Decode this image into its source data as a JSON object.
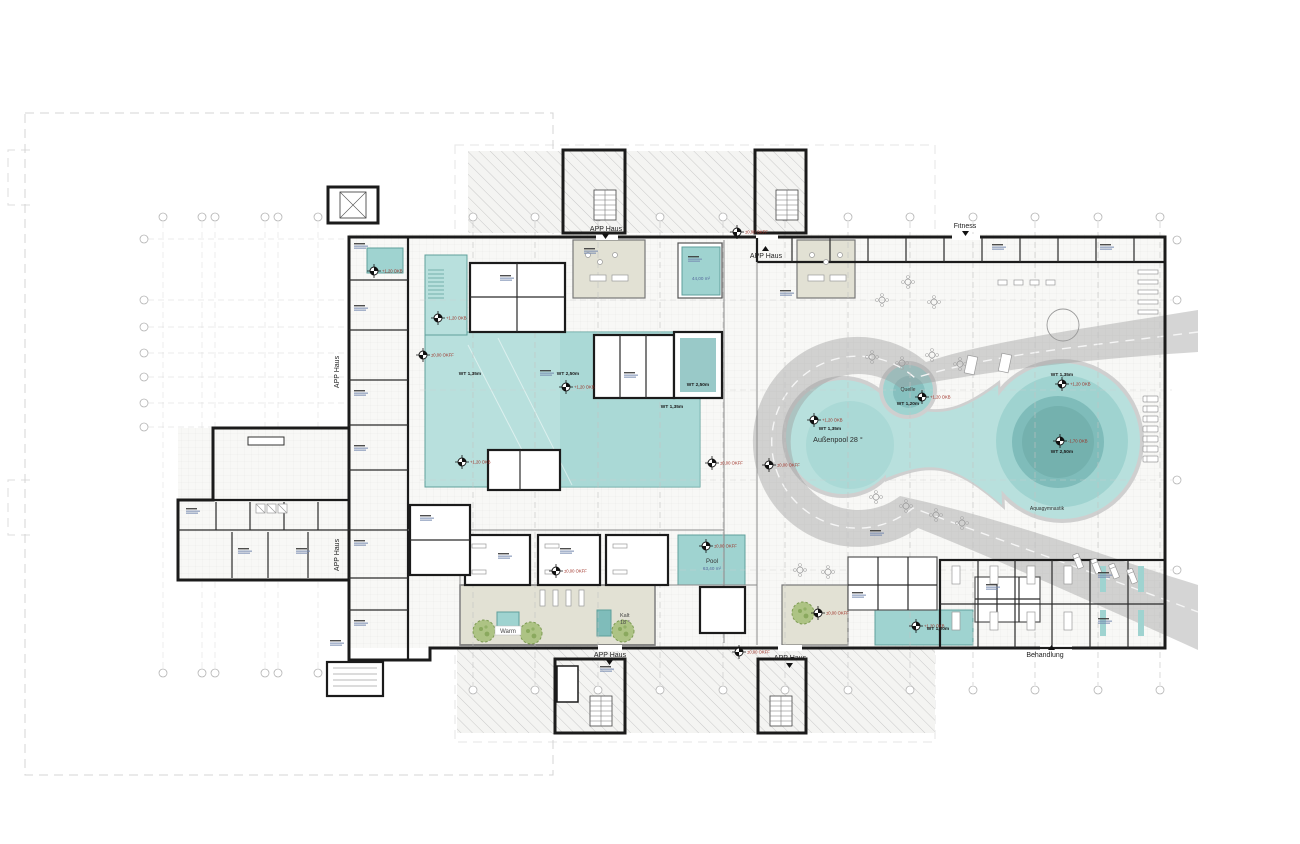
{
  "plan": {
    "areas": {
      "fitness": "Fitness",
      "behandlung": "Behandlung",
      "app_haus": "APP Haus",
      "aussenpool": "Außenpool 28 °",
      "quelle": "Quelle",
      "aquagym": "Aquagymnastik",
      "warm": "Warm",
      "kalt1": "Kalt",
      "kalt2": "18 °",
      "pool": "Pool"
    },
    "measurements": {
      "pool_area": "63,40 m²",
      "small_pool_area": "44,00 m²",
      "wt135": "WT 1,35m",
      "wt250": "WT 2,50m",
      "wt120": "WT 1,20m"
    },
    "levels": {
      "okff0": "±0,00 OKFF",
      "okb120": "+1,20 OKB",
      "okb170n": "-1,70 OKB"
    },
    "colors": {
      "pool_light": "#b8e0dd",
      "pool_mid": "#9fd3d0",
      "pool_deep": "#7fbcba",
      "pool_deepest": "#74b1ae",
      "band_gray": "#9a9a9a",
      "beige": "#e2e1d4",
      "tree_green": "#a3bd76",
      "wall_black": "#1b1b1b"
    }
  }
}
